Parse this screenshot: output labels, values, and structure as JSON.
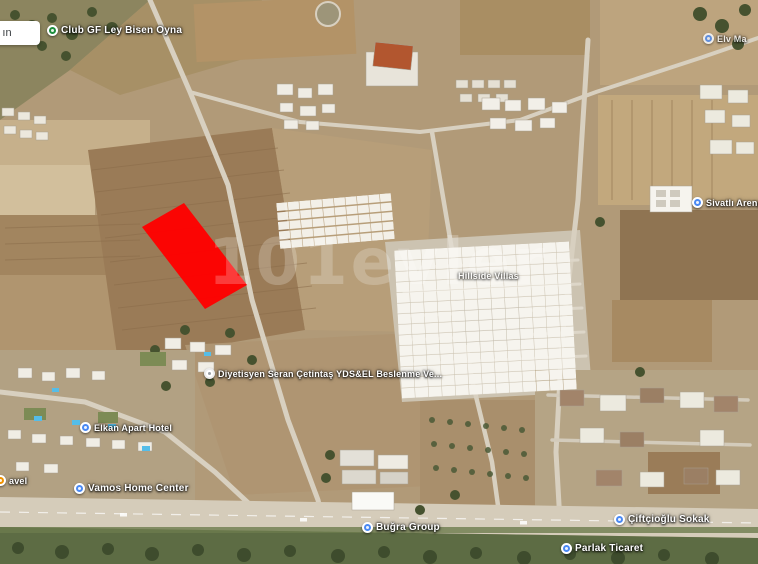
{
  "map": {
    "watermark": "101evler",
    "cutoff_label": "ın",
    "parcel_highlight_color": "#ff0000",
    "icon_colors": {
      "blue_place": "#4a89f3",
      "green_place": "#1e8e3e",
      "orange_place": "#f09300",
      "white_place": "#ffffff"
    },
    "labels": [
      {
        "id": "club",
        "icon": "green-place-icon",
        "text": "Club GF Ley Bisen Oyna"
      },
      {
        "id": "dietitian",
        "icon": "white-place-icon",
        "text": "Diyetisyen Seran Çetintaş  YDS&EL Beslenme Ve..."
      },
      {
        "id": "elkan",
        "icon": "blue-place-icon",
        "text": "Elkan Apart Hotel"
      },
      {
        "id": "travel-cut",
        "icon": "orange-place-icon",
        "text": "avel"
      },
      {
        "id": "vamos",
        "icon": "blue-place-icon",
        "text": "Vamos Home Center"
      },
      {
        "id": "bugra",
        "icon": "blue-place-icon",
        "text": "Buğra Group"
      },
      {
        "id": "ciftcioglu",
        "icon": "blue-place-icon",
        "text": "Çiftçioğlu Sokak"
      },
      {
        "id": "parlak",
        "icon": "blue-place-icon",
        "text": "Parlak Ticaret"
      },
      {
        "id": "sivatli-cut",
        "icon": "blue-place-icon",
        "text": "Sivatlı Areng"
      },
      {
        "id": "elv-cut",
        "icon": "blue-place-icon",
        "text": "Elv Ma"
      },
      {
        "id": "hillside",
        "icon": "none",
        "text": "Hillside Villas"
      }
    ]
  }
}
